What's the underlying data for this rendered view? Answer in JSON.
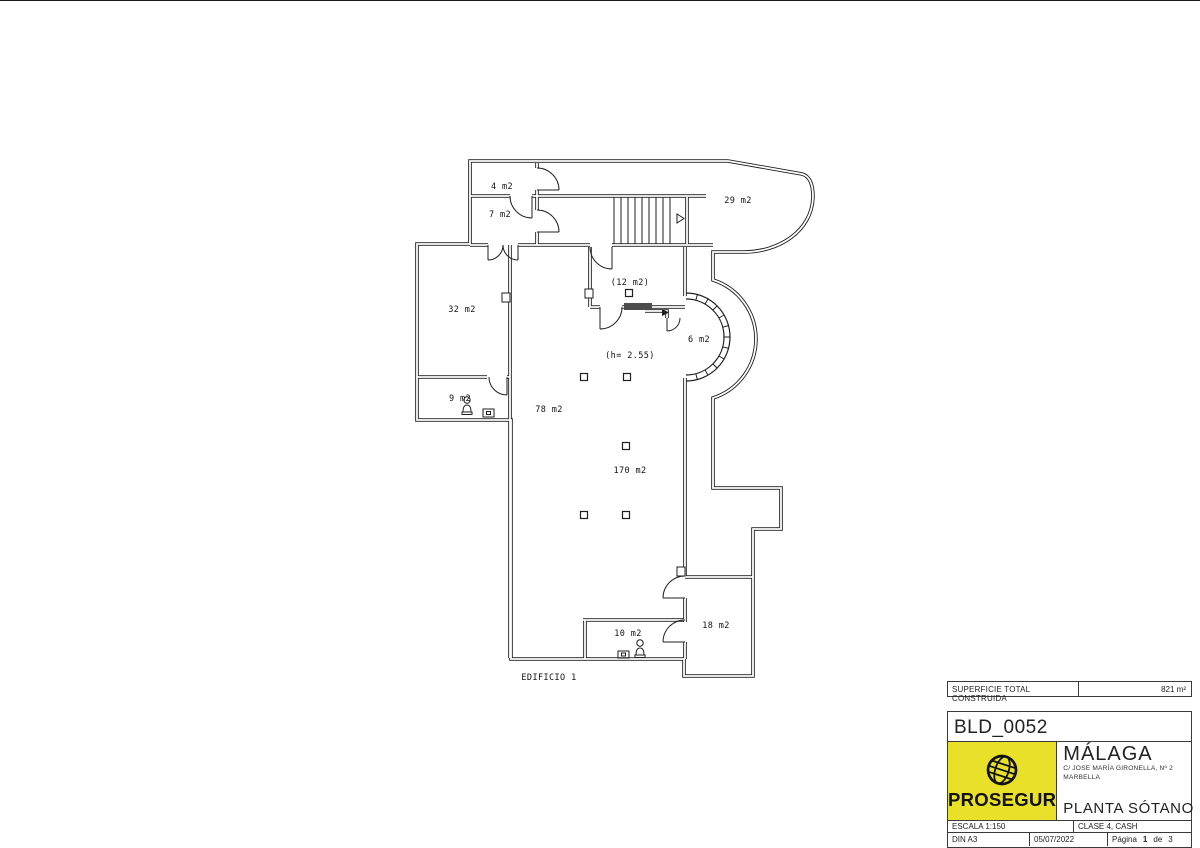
{
  "plan": {
    "room_4": "4 m2",
    "room_7": "7 m2",
    "room_29": "29 m2",
    "room_32": "32 m2",
    "room_12": "(12 m2)",
    "room_6": "6 m2",
    "room_9": "9 m2",
    "room_78": "78 m2",
    "room_170": "170 m2",
    "room_10": "10 m2",
    "room_18": "18 m2",
    "height_note": "(h= 2.55)",
    "building_label": "EDIFICIO 1"
  },
  "summary_bar": {
    "label": "SUPERFICIE TOTAL CONSTRUIDA",
    "value": "821 m²"
  },
  "title_block": {
    "code": "BLD_0052",
    "brand": "PROSEGUR",
    "city": "MÁLAGA",
    "address_line1": "C/ JOSE MARÍA GIRONELLA, Nº 2",
    "address_line2": "MARBELLA",
    "drawing_title": "PLANTA SÓTANO",
    "scale": "ESCALA 1:150",
    "classification": "CLASE 4, CASH",
    "paper": "DIN A3",
    "date": "05/07/2022",
    "page_label": "Página",
    "page_number": "1",
    "page_of": "de",
    "page_total": "3"
  },
  "icons": {
    "logo": "globe-icon",
    "plan_markers": [
      "person-icon",
      "desk-icon",
      "stairs-direction-arrow-icon"
    ]
  },
  "colors": {
    "brand_yellow": "#e9e02a",
    "line_color": "#1f1f1f"
  }
}
